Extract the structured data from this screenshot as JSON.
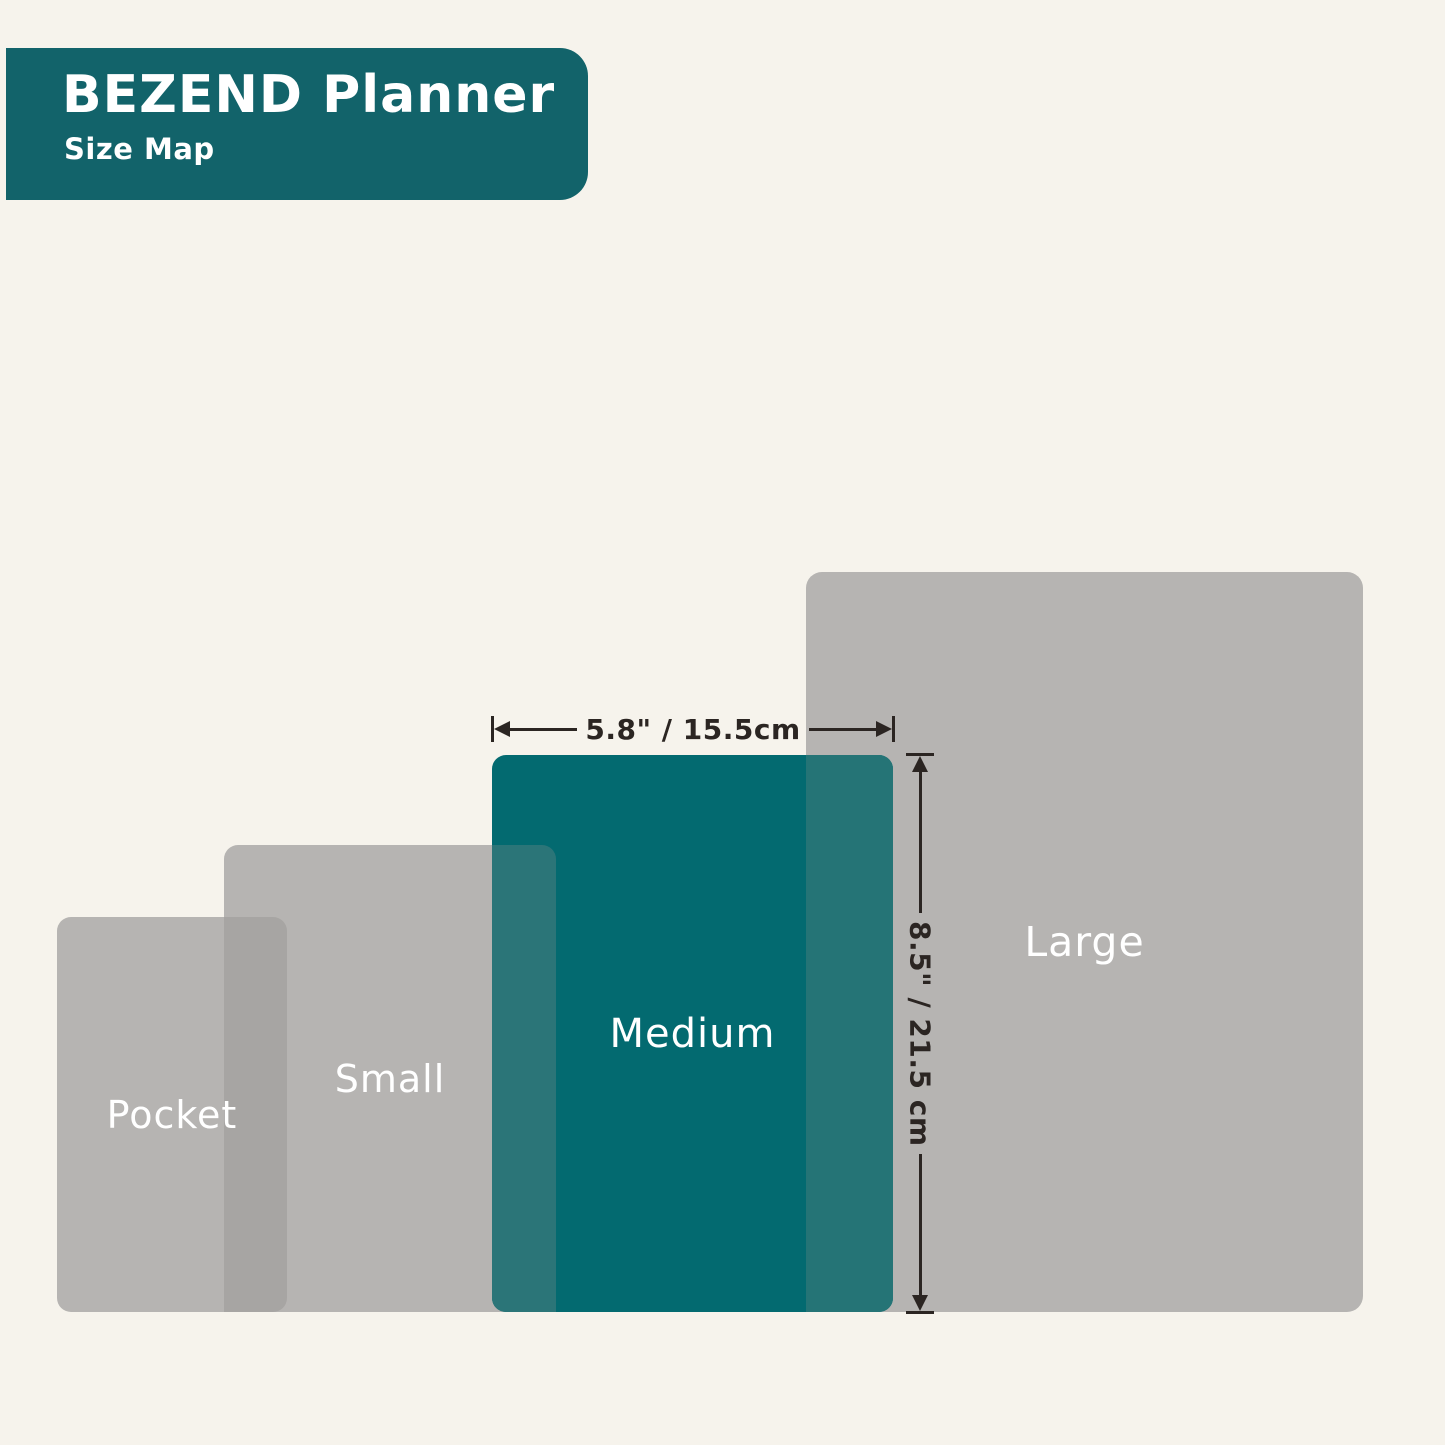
{
  "header": {
    "title": "BEZEND Planner",
    "subtitle": "Size Map"
  },
  "sizes": [
    {
      "id": "pocket",
      "label": "Pocket"
    },
    {
      "id": "small",
      "label": "Small"
    },
    {
      "id": "medium",
      "label": "Medium",
      "highlighted": true
    },
    {
      "id": "large",
      "label": "Large"
    }
  ],
  "dimensions": {
    "medium_width_label": "5.8\" / 15.5cm",
    "medium_height_label": "8.5\" / 21.5 cm"
  },
  "colors": {
    "background": "#f6f3ec",
    "banner_teal": "#12636a",
    "medium_teal": "#036a70",
    "teal_small_overlap": "#2b7578",
    "teal_large_overlap": "#257476",
    "gray": "#b6b4b2",
    "gray_overlap": "#a7a5a3",
    "label_white": "#ffffff",
    "dimension_dark": "#2b2522"
  }
}
